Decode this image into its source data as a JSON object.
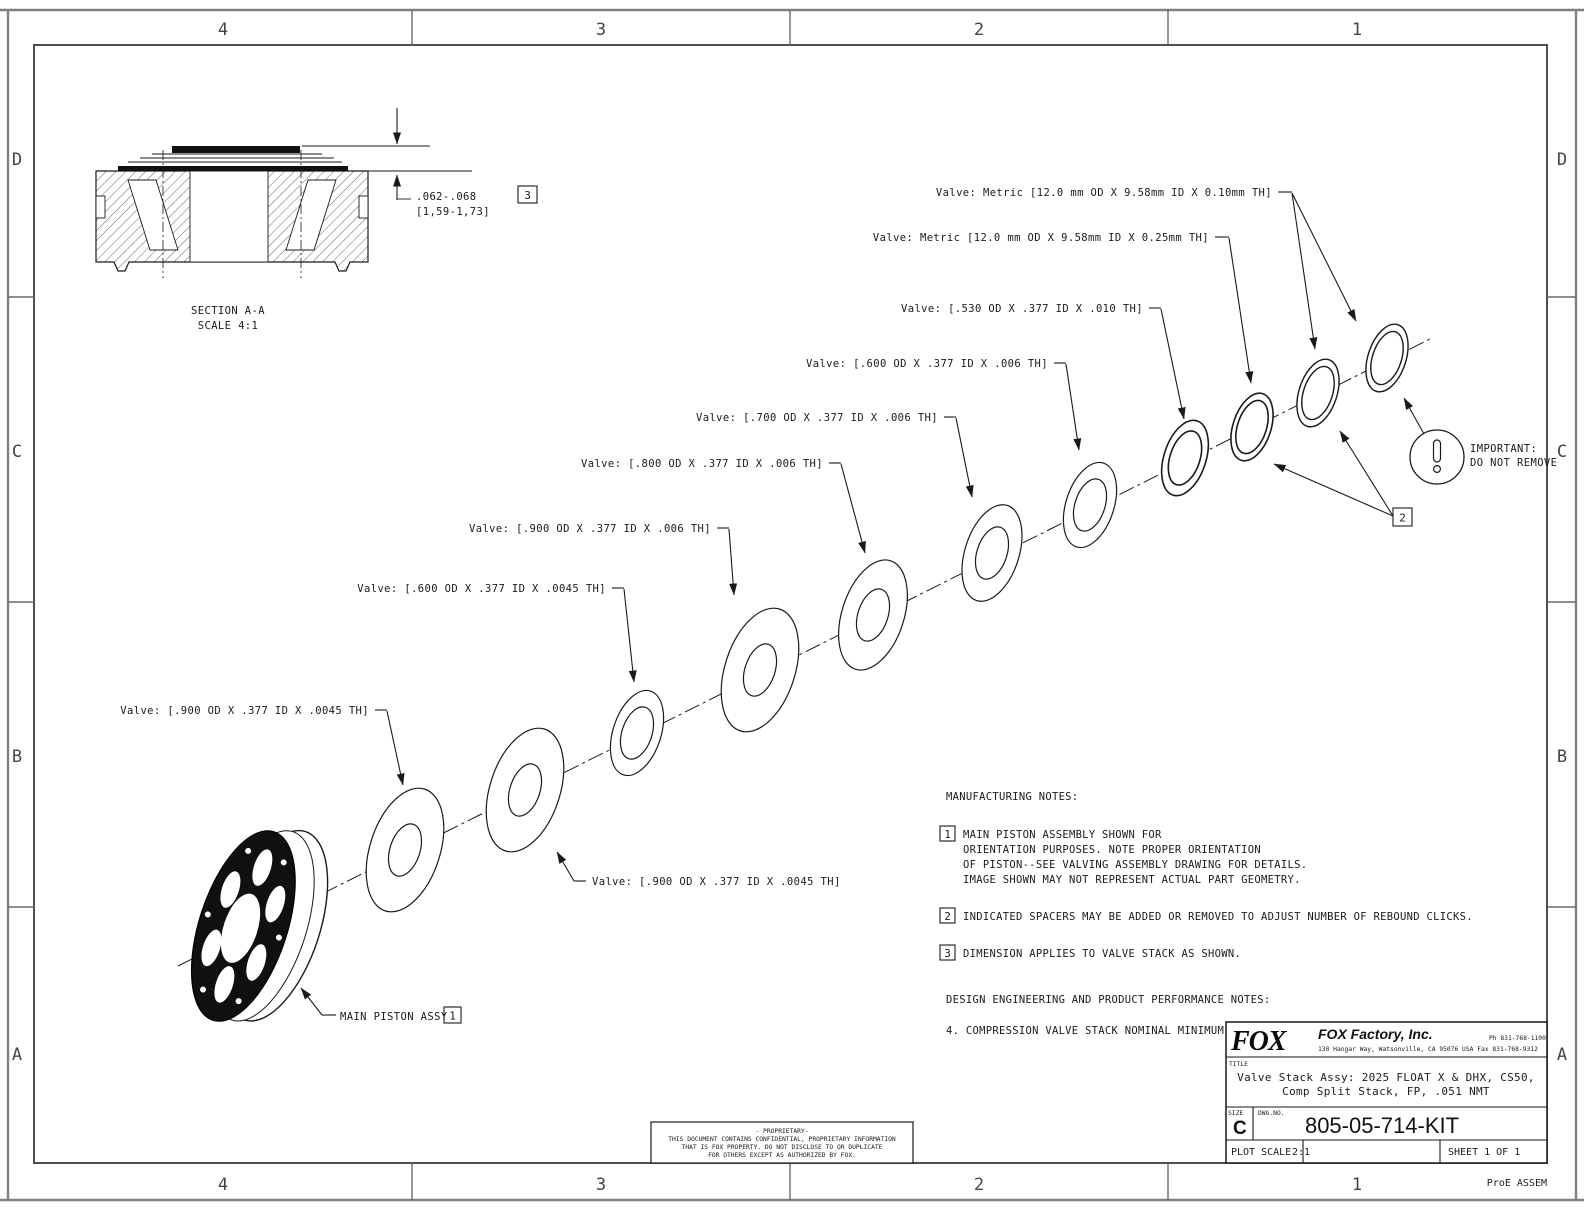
{
  "border": {
    "top_zones": [
      "4",
      "3",
      "2",
      "1"
    ],
    "bottom_zones": [
      "4",
      "3",
      "2",
      "1"
    ],
    "left_zones": [
      "D",
      "C",
      "B",
      "A"
    ],
    "right_zones": [
      "D",
      "C",
      "B",
      "A"
    ],
    "footer_note": "ProE ASSEM"
  },
  "section_view": {
    "label": "SECTION A-A",
    "scale": "SCALE 4:1",
    "dim": ".062-.068",
    "dim_metric": "[1,59-1,73]",
    "dim_ref": "3"
  },
  "callouts": [
    "Valve: Metric [12.0 mm OD X 9.58mm ID X 0.10mm TH]",
    "Valve: Metric [12.0 mm OD X 9.58mm ID X 0.25mm TH]",
    "Valve: [.530 OD X .377 ID X .010 TH]",
    "Valve: [.600 OD X .377 ID X .006 TH]",
    "Valve: [.700 OD X .377 ID X .006 TH]",
    "Valve: [.800 OD X .377 ID X .006 TH]",
    "Valve: [.900 OD X .377 ID X .006 TH]",
    "Valve: [.600 OD X .377 ID X .0045 TH]",
    "Valve: [.900 OD X .377 ID X .0045 TH]",
    "Valve: [.900 OD X .377 ID X .0045 TH]",
    "MAIN PISTON ASSY"
  ],
  "refs": {
    "piston": "1",
    "spacer": "2",
    "dim": "3"
  },
  "important": {
    "title": "IMPORTANT:",
    "body": "DO NOT REMOVE"
  },
  "notes": {
    "heading": "MANUFACTURING NOTES:",
    "n1_ref": "1",
    "n1_lines": [
      "MAIN PISTON ASSEMBLY SHOWN FOR",
      "ORIENTATION PURPOSES. NOTE PROPER ORIENTATION",
      "OF PISTON--SEE VALVING ASSEMBLY DRAWING FOR DETAILS.",
      "IMAGE SHOWN MAY NOT REPRESENT ACTUAL PART GEOMETRY."
    ],
    "n2_ref": "2",
    "n2_text": "INDICATED SPACERS MAY BE ADDED OR REMOVED TO ADJUST NUMBER OF REBOUND CLICKS.",
    "n3_ref": "3",
    "n3_text": "DIMENSION APPLIES TO VALVE STACK AS SHOWN.",
    "design_heading": "DESIGN ENGINEERING AND PRODUCT PERFORMANCE NOTES:",
    "n4_text": "4. COMPRESSION VALVE STACK NOMINAL MINIMUM THICKNESS (NMT): 0.051 [1,31]"
  },
  "proprietary": {
    "l1": "- PROPRIETARY-",
    "l2": "THIS DOCUMENT CONTAINS CONFIDENTIAL, PROPRIETARY INFORMATION",
    "l3": "THAT IS FOX PROPERTY.  DO NOT DISCLOSE TO OR DUPLICATE",
    "l4": "FOR OTHERS EXCEPT AS AUTHORIZED BY FOX."
  },
  "title_block": {
    "logo": "FOX",
    "company": "FOX Factory, Inc.",
    "phone": "Ph 831-768-1100",
    "address": "130 Hangar Way, Watsonville, CA 95076 USA  Fax 831-768-9312",
    "title_label": "TITLE",
    "title_line1": "Valve Stack Assy: 2025 FLOAT X & DHX, CS50,",
    "title_line2": "Comp Split Stack, FP, .051 NMT",
    "size_label": "SIZE",
    "size": "C",
    "dwg_label": "DWG.NO.",
    "dwg_no": "805-05-714-KIT",
    "plot_scale_label": "PLOT SCALE",
    "plot_scale": "2:1",
    "sheet": "SHEET 1 OF 1"
  }
}
